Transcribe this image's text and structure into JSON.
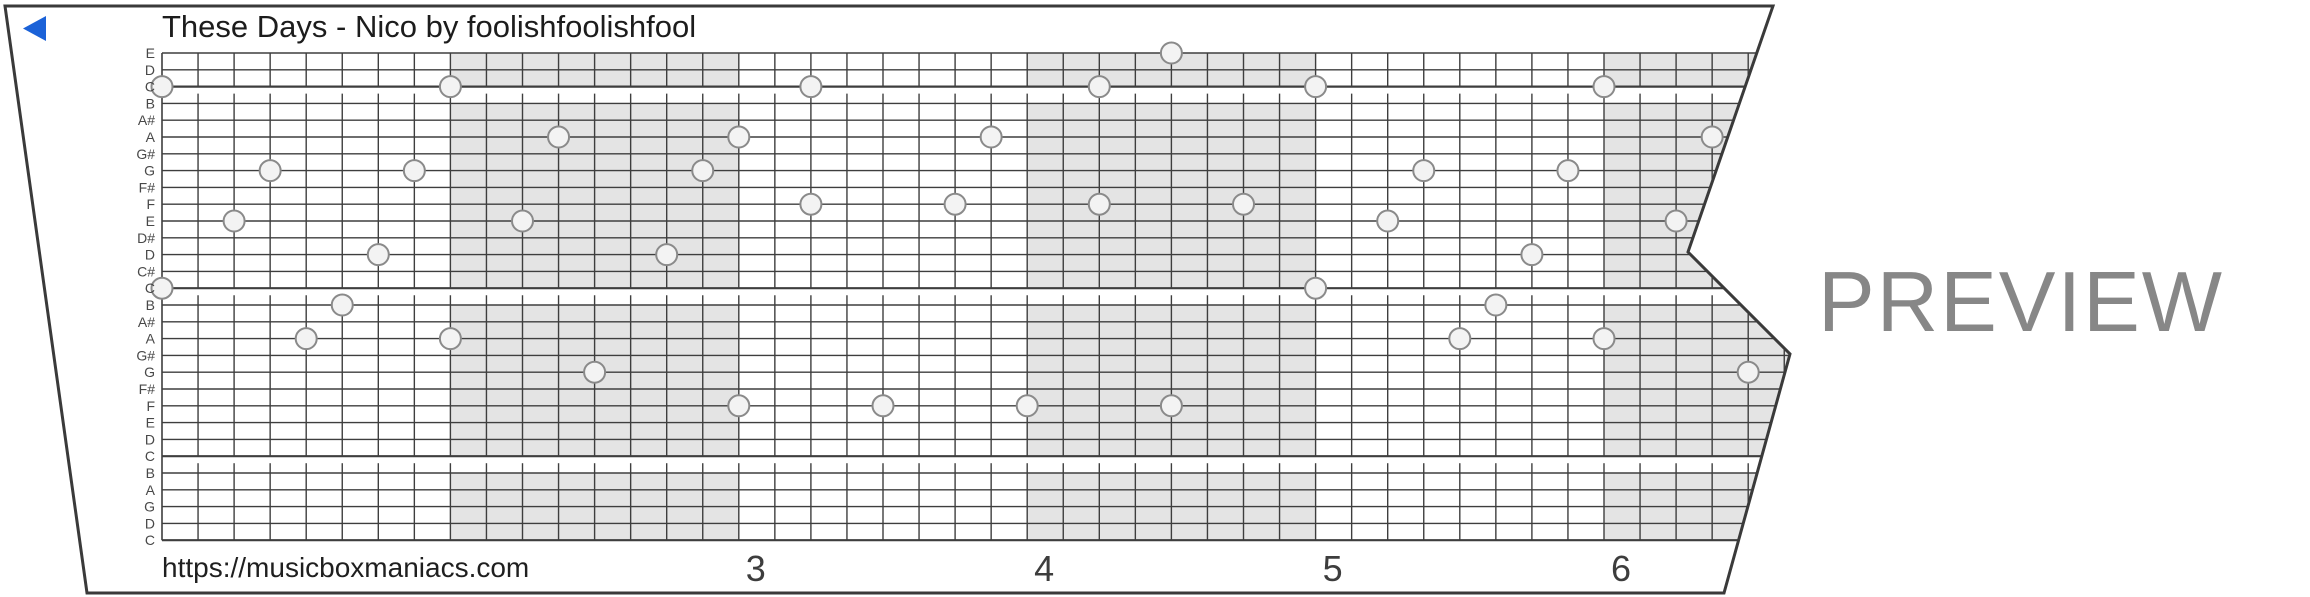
{
  "header": {
    "title": "These Days - Nico by foolishfoolishfool"
  },
  "footer": {
    "url": "https://musicboxmaniacs.com"
  },
  "watermark": {
    "label": "PREVIEW"
  },
  "icons": {
    "play": "left-pointing-triangle"
  },
  "colors": {
    "accent_blue": "#1b62d8",
    "band_gray": "#e4e4e4",
    "grid_line": "#3e3e3e",
    "strip_border": "#3a3a3a",
    "note_fill": "#f3f3f3",
    "note_stroke": "#8a8a8a",
    "watermark_gray": "#878787",
    "label_gray": "#484848",
    "number_gray": "#3d3d3d"
  },
  "note_labels": [
    "E",
    "D",
    "C",
    "B",
    "A#",
    "A",
    "G#",
    "G",
    "F#",
    "F",
    "E",
    "D#",
    "D",
    "C#",
    "C",
    "B",
    "A#",
    "A",
    "G#",
    "G",
    "F#",
    "F",
    "E",
    "D",
    "C",
    "B",
    "A",
    "G",
    "D",
    "C"
  ],
  "c_separator_rows": [
    2,
    14,
    24
  ],
  "measure_numbers": [
    {
      "label": "3",
      "col": 16
    },
    {
      "label": "4",
      "col": 24
    },
    {
      "label": "5",
      "col": 32
    },
    {
      "label": "6",
      "col": 40
    }
  ],
  "shaded_measures": [
    {
      "start_col": 8,
      "end_col": 16
    },
    {
      "start_col": 24,
      "end_col": 32
    },
    {
      "start_col": 40,
      "end_col": 48
    }
  ],
  "notes": [
    {
      "col": 0,
      "pitch": "C",
      "row": 2
    },
    {
      "col": 0,
      "pitch": "C",
      "row": 14
    },
    {
      "col": 2,
      "pitch": "E",
      "row": 10
    },
    {
      "col": 3,
      "pitch": "G",
      "row": 7
    },
    {
      "col": 4,
      "pitch": "A",
      "row": 17
    },
    {
      "col": 5,
      "pitch": "B",
      "row": 15
    },
    {
      "col": 6,
      "pitch": "D",
      "row": 12
    },
    {
      "col": 7,
      "pitch": "G",
      "row": 7
    },
    {
      "col": 8,
      "pitch": "C",
      "row": 2
    },
    {
      "col": 8,
      "pitch": "A",
      "row": 17
    },
    {
      "col": 10,
      "pitch": "E",
      "row": 10
    },
    {
      "col": 11,
      "pitch": "A",
      "row": 5
    },
    {
      "col": 12,
      "pitch": "G",
      "row": 19
    },
    {
      "col": 14,
      "pitch": "D",
      "row": 12
    },
    {
      "col": 15,
      "pitch": "G",
      "row": 7
    },
    {
      "col": 16,
      "pitch": "A",
      "row": 5
    },
    {
      "col": 16,
      "pitch": "F",
      "row": 21
    },
    {
      "col": 18,
      "pitch": "C",
      "row": 2
    },
    {
      "col": 18,
      "pitch": "F",
      "row": 9
    },
    {
      "col": 20,
      "pitch": "F",
      "row": 21
    },
    {
      "col": 22,
      "pitch": "F",
      "row": 9
    },
    {
      "col": 23,
      "pitch": "A",
      "row": 5
    },
    {
      "col": 24,
      "pitch": "F",
      "row": 21
    },
    {
      "col": 26,
      "pitch": "C",
      "row": 2
    },
    {
      "col": 26,
      "pitch": "F",
      "row": 9
    },
    {
      "col": 28,
      "pitch": "E",
      "row": 0
    },
    {
      "col": 28,
      "pitch": "F",
      "row": 21
    },
    {
      "col": 30,
      "pitch": "F",
      "row": 9
    },
    {
      "col": 32,
      "pitch": "C",
      "row": 2
    },
    {
      "col": 32,
      "pitch": "C",
      "row": 14
    },
    {
      "col": 34,
      "pitch": "E",
      "row": 10
    },
    {
      "col": 35,
      "pitch": "G",
      "row": 7
    },
    {
      "col": 36,
      "pitch": "A",
      "row": 17
    },
    {
      "col": 37,
      "pitch": "B",
      "row": 15
    },
    {
      "col": 38,
      "pitch": "D",
      "row": 12
    },
    {
      "col": 39,
      "pitch": "G",
      "row": 7
    },
    {
      "col": 40,
      "pitch": "C",
      "row": 2
    },
    {
      "col": 40,
      "pitch": "A",
      "row": 17
    },
    {
      "col": 42,
      "pitch": "E",
      "row": 10
    },
    {
      "col": 43,
      "pitch": "A",
      "row": 5
    },
    {
      "col": 44,
      "pitch": "G",
      "row": 19
    }
  ]
}
